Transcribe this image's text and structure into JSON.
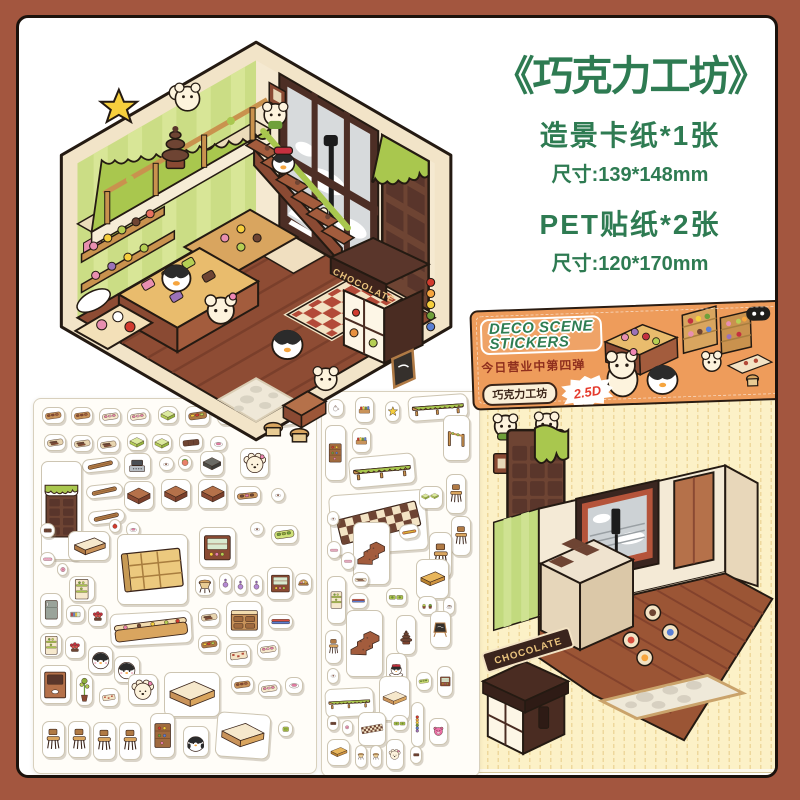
{
  "colors": {
    "frame": "#a3563f",
    "accent_green": "#2e7b52",
    "package_orange": "#ee9c5b",
    "card_yellow": "#fcf1c7",
    "choc_brown": "#6e4433",
    "slime_green": "#a9c74e",
    "badge_red": "#e5392b"
  },
  "title_block": {
    "title": "《巧克力工坊》",
    "lines": [
      {
        "text": "造景卡纸*1张"
      },
      {
        "text": "尺寸:139*148mm"
      },
      {
        "text": "PET贴纸*2张"
      },
      {
        "text": "尺寸:120*170mm"
      }
    ]
  },
  "package": {
    "logo_line1": "DECO SCENE",
    "logo_line2": "STICKERS",
    "subtitle": "今日营业中第四弹",
    "pill": "巧克力工坊",
    "badge": "2.5D"
  },
  "scene": {
    "kiosk_sign": "CHOCOLATE",
    "new_tag": "NEW"
  },
  "card": {
    "kiosk_sign": "CHOCOLATE"
  },
  "sheets": {
    "sheet1": {
      "stickers": [
        {
          "t": "tray",
          "x": 3,
          "y": 2.2,
          "w": 8,
          "h": 4.6
        },
        {
          "t": "tray",
          "x": 13,
          "y": 2.2,
          "w": 8,
          "h": 4.6
        },
        {
          "t": "traypink",
          "x": 23,
          "y": 2.4,
          "w": 8,
          "h": 4.6
        },
        {
          "t": "traypink",
          "x": 33,
          "y": 2.4,
          "w": 8,
          "h": 4.6
        },
        {
          "t": "greencube",
          "x": 44,
          "y": 1.8,
          "w": 7,
          "h": 5
        },
        {
          "t": "trayfull",
          "x": 53.5,
          "y": 2,
          "w": 9,
          "h": 5.2
        },
        {
          "t": "eclair",
          "x": 65,
          "y": 2.4,
          "w": 7,
          "h": 4.6
        },
        {
          "t": "benchcurve",
          "x": 74,
          "y": 1.6,
          "w": 23,
          "h": 6,
          "r": -7
        },
        {
          "t": "choctray",
          "x": 3.5,
          "y": 9.3,
          "w": 8,
          "h": 4.6
        },
        {
          "t": "choctray",
          "x": 13,
          "y": 9.5,
          "w": 8,
          "h": 4.6
        },
        {
          "t": "choctray",
          "x": 22.5,
          "y": 9.8,
          "w": 8,
          "h": 4.6
        },
        {
          "t": "greencube",
          "x": 33,
          "y": 9,
          "w": 7,
          "h": 5
        },
        {
          "t": "greencube",
          "x": 42,
          "y": 9.3,
          "w": 7,
          "h": 5
        },
        {
          "t": "chocflat",
          "x": 51.5,
          "y": 9,
          "w": 8.5,
          "h": 5
        },
        {
          "t": "dish",
          "x": 62.5,
          "y": 9.8,
          "w": 6,
          "h": 4.2
        },
        {
          "t": "plank",
          "x": 17,
          "y": 15.8,
          "w": 13,
          "h": 3.8,
          "r": -6
        },
        {
          "t": "register",
          "x": 32,
          "y": 14.4,
          "w": 9.5,
          "h": 6.8
        },
        {
          "t": "dishsm",
          "x": 44.5,
          "y": 15.4,
          "w": 5,
          "h": 3.8
        },
        {
          "t": "melon",
          "x": 51,
          "y": 15,
          "w": 5,
          "h": 4
        },
        {
          "t": "darkpot",
          "x": 59,
          "y": 13.8,
          "w": 8.5,
          "h": 6.8
        },
        {
          "t": "puppy",
          "x": 73,
          "y": 13.2,
          "w": 10.5,
          "h": 8
        },
        {
          "t": "chocbar",
          "x": 2.5,
          "y": 16.5,
          "w": 14.5,
          "h": 26.5
        },
        {
          "t": "plank",
          "x": 18.5,
          "y": 22.8,
          "w": 13,
          "h": 3.8,
          "r": -6
        },
        {
          "t": "cube",
          "x": 32,
          "y": 21.8,
          "w": 10.5,
          "h": 8
        },
        {
          "t": "cube",
          "x": 45,
          "y": 21.4,
          "w": 10.5,
          "h": 8
        },
        {
          "t": "cube",
          "x": 58,
          "y": 21.4,
          "w": 10.5,
          "h": 8
        },
        {
          "t": "traywide",
          "x": 71,
          "y": 23.2,
          "w": 9.5,
          "h": 5
        },
        {
          "t": "dishsm",
          "x": 84,
          "y": 23.8,
          "w": 5,
          "h": 3.8
        },
        {
          "t": "plank",
          "x": 19,
          "y": 29.8,
          "w": 13,
          "h": 3.8,
          "r": -6
        },
        {
          "t": "apple",
          "x": 26.5,
          "y": 32.2,
          "w": 4.2,
          "h": 3.6
        },
        {
          "t": "dish",
          "x": 32.5,
          "y": 32.8,
          "w": 5.2,
          "h": 4
        },
        {
          "t": "bench",
          "x": 12,
          "y": 35.2,
          "w": 15,
          "h": 8
        },
        {
          "t": "choco",
          "x": 2,
          "y": 33.2,
          "w": 5.5,
          "h": 4
        },
        {
          "t": "shelfbig",
          "x": 29.5,
          "y": 36,
          "w": 25,
          "h": 19
        },
        {
          "t": "cabinet",
          "x": 58.5,
          "y": 34.2,
          "w": 13,
          "h": 11
        },
        {
          "t": "dishsm",
          "x": 76.5,
          "y": 32.8,
          "w": 5,
          "h": 3.8
        },
        {
          "t": "greentray",
          "x": 84,
          "y": 33.8,
          "w": 9.5,
          "h": 5
        },
        {
          "t": "candy",
          "x": 2,
          "y": 40.8,
          "w": 5.5,
          "h": 3.8
        },
        {
          "t": "pinkdot",
          "x": 8,
          "y": 43.8,
          "w": 4.2,
          "h": 3.5
        },
        {
          "t": "greenrack",
          "x": 12.5,
          "y": 47.2,
          "w": 9,
          "h": 7
        },
        {
          "t": "stool",
          "x": 57,
          "y": 47,
          "w": 7,
          "h": 5.8
        },
        {
          "t": "bottle",
          "x": 65.5,
          "y": 46.6,
          "w": 4.6,
          "h": 5.4
        },
        {
          "t": "bottle",
          "x": 71,
          "y": 47,
          "w": 4.6,
          "h": 5.4
        },
        {
          "t": "bottle",
          "x": 76.5,
          "y": 47,
          "w": 4.6,
          "h": 5.4
        },
        {
          "t": "cabinet",
          "x": 82.5,
          "y": 45,
          "w": 9.5,
          "h": 8.8
        },
        {
          "t": "basket",
          "x": 92.5,
          "y": 46.4,
          "w": 6,
          "h": 5.6
        },
        {
          "t": "fridge",
          "x": 2,
          "y": 52,
          "w": 8,
          "h": 9
        },
        {
          "t": "books",
          "x": 11.5,
          "y": 55,
          "w": 6.5,
          "h": 5
        },
        {
          "t": "roses",
          "x": 19,
          "y": 55,
          "w": 7,
          "h": 6
        },
        {
          "t": "counter",
          "x": 27,
          "y": 57,
          "w": 29,
          "h": 8.8,
          "r": -3
        },
        {
          "t": "choctray",
          "x": 58,
          "y": 56,
          "w": 8,
          "h": 5
        },
        {
          "t": "desk",
          "x": 68,
          "y": 54,
          "w": 13,
          "h": 10
        },
        {
          "t": "bluebar",
          "x": 83,
          "y": 57.4,
          "w": 9,
          "h": 4
        },
        {
          "t": "greenrack",
          "x": 2,
          "y": 62.5,
          "w": 8,
          "h": 6.5
        },
        {
          "t": "roses",
          "x": 11,
          "y": 63.5,
          "w": 7,
          "h": 6
        },
        {
          "t": "penguinface",
          "x": 19,
          "y": 66,
          "w": 9,
          "h": 7.4
        },
        {
          "t": "penguinface",
          "x": 28.5,
          "y": 68.6,
          "w": 9,
          "h": 7.4
        },
        {
          "t": "trayfull",
          "x": 58,
          "y": 63,
          "w": 8,
          "h": 5
        },
        {
          "t": "rug",
          "x": 68,
          "y": 65.4,
          "w": 9,
          "h": 6
        },
        {
          "t": "traypink",
          "x": 79,
          "y": 64.4,
          "w": 8,
          "h": 5
        },
        {
          "t": "shelfopen",
          "x": 2,
          "y": 71,
          "w": 11,
          "h": 10.5
        },
        {
          "t": "planttall",
          "x": 15,
          "y": 73.5,
          "w": 6,
          "h": 8.5
        },
        {
          "t": "rug",
          "x": 23,
          "y": 77.4,
          "w": 7,
          "h": 5
        },
        {
          "t": "puppy",
          "x": 33.5,
          "y": 73.4,
          "w": 10.5,
          "h": 8.4
        },
        {
          "t": "lbench",
          "x": 46,
          "y": 73,
          "w": 20,
          "h": 12
        },
        {
          "t": "tray",
          "x": 70,
          "y": 74,
          "w": 8,
          "h": 4.6
        },
        {
          "t": "traypink",
          "x": 79.5,
          "y": 75,
          "w": 8,
          "h": 4.6
        },
        {
          "t": "dish",
          "x": 89,
          "y": 74.4,
          "w": 6.5,
          "h": 4.4
        },
        {
          "t": "chair",
          "x": 3,
          "y": 86,
          "w": 8,
          "h": 10
        },
        {
          "t": "chair",
          "x": 12,
          "y": 86,
          "w": 8,
          "h": 10
        },
        {
          "t": "chair",
          "x": 21,
          "y": 86.4,
          "w": 8,
          "h": 10
        },
        {
          "t": "chair",
          "x": 30,
          "y": 86.4,
          "w": 8,
          "h": 10
        },
        {
          "t": "shelfcol",
          "x": 41,
          "y": 84,
          "w": 9,
          "h": 12
        },
        {
          "t": "penguinbody",
          "x": 53,
          "y": 87.4,
          "w": 9,
          "h": 8.4
        },
        {
          "t": "lbench",
          "x": 64.5,
          "y": 84,
          "w": 19,
          "h": 12,
          "r": 4
        },
        {
          "t": "foodsq",
          "x": 86.5,
          "y": 86,
          "w": 5.5,
          "h": 4.4
        }
      ]
    },
    "sheet2": {
      "stickers": [
        {
          "t": "teapot",
          "x": 4,
          "y": 1.8,
          "w": 10,
          "h": 4.8
        },
        {
          "t": "crate",
          "x": 21,
          "y": 1.4,
          "w": 12,
          "h": 6.6
        },
        {
          "t": "star",
          "x": 40,
          "y": 2.4,
          "w": 10,
          "h": 5.4
        },
        {
          "t": "railing",
          "x": 55,
          "y": 0.8,
          "w": 38,
          "h": 6.6,
          "r": -4
        },
        {
          "t": "crate",
          "x": 19,
          "y": 9.4,
          "w": 12,
          "h": 6.6
        },
        {
          "t": "shelfcol",
          "x": 2,
          "y": 8.6,
          "w": 13,
          "h": 14.5
        },
        {
          "t": "railing",
          "x": 17,
          "y": 16.4,
          "w": 42,
          "h": 8,
          "r": -5
        },
        {
          "t": "vrail",
          "x": 77,
          "y": 6,
          "w": 17,
          "h": 12
        },
        {
          "t": "checker",
          "x": 5,
          "y": 26,
          "w": 62,
          "h": 16,
          "r": -4
        },
        {
          "t": "greencubes",
          "x": 62,
          "y": 24.4,
          "w": 15,
          "h": 6
        },
        {
          "t": "chair",
          "x": 79,
          "y": 21.4,
          "w": 13,
          "h": 10.4
        },
        {
          "t": "chair",
          "x": 82,
          "y": 32.4,
          "w": 13,
          "h": 10.4
        },
        {
          "t": "dishsm",
          "x": 3,
          "y": 31,
          "w": 8,
          "h": 4
        },
        {
          "t": "stairs",
          "x": 20,
          "y": 33.8,
          "w": 23,
          "h": 16.5
        },
        {
          "t": "orangebar",
          "x": 49,
          "y": 34.4,
          "w": 13,
          "h": 4,
          "r": -10
        },
        {
          "t": "candy",
          "x": 3,
          "y": 38.8,
          "w": 9,
          "h": 4.8
        },
        {
          "t": "candy",
          "x": 12,
          "y": 41.6,
          "w": 9,
          "h": 4.8
        },
        {
          "t": "chair",
          "x": 68,
          "y": 36.4,
          "w": 15,
          "h": 12
        },
        {
          "t": "chocsticks",
          "x": 19,
          "y": 46.8,
          "w": 11,
          "h": 4
        },
        {
          "t": "table",
          "x": 60,
          "y": 43.4,
          "w": 21,
          "h": 10.6
        },
        {
          "t": "greenrack",
          "x": 3,
          "y": 48,
          "w": 12,
          "h": 12.5
        },
        {
          "t": "bluebar",
          "x": 17,
          "y": 52.4,
          "w": 12,
          "h": 4
        },
        {
          "t": "greenpads",
          "x": 41,
          "y": 51,
          "w": 13,
          "h": 4.8
        },
        {
          "t": "pots",
          "x": 61,
          "y": 53,
          "w": 12,
          "h": 5.2
        },
        {
          "t": "teacup",
          "x": 77,
          "y": 53.4,
          "w": 8,
          "h": 4.8
        },
        {
          "t": "stairs",
          "x": 15,
          "y": 56.8,
          "w": 24,
          "h": 17.5
        },
        {
          "t": "blackboard",
          "x": 69,
          "y": 57,
          "w": 13,
          "h": 9.6
        },
        {
          "t": "chair",
          "x": 2,
          "y": 62,
          "w": 11,
          "h": 8.8
        },
        {
          "t": "fountain",
          "x": 47,
          "y": 58,
          "w": 13,
          "h": 10.6
        },
        {
          "t": "penguincake",
          "x": 41,
          "y": 68,
          "w": 13,
          "h": 8.8
        },
        {
          "t": "dishsm",
          "x": 3,
          "y": 72,
          "w": 8,
          "h": 4
        },
        {
          "t": "railing",
          "x": 2,
          "y": 77,
          "w": 31,
          "h": 7.6,
          "r": -3
        },
        {
          "t": "lbench",
          "x": 36,
          "y": 74,
          "w": 20,
          "h": 11.6
        },
        {
          "t": "greentray",
          "x": 60,
          "y": 73,
          "w": 10,
          "h": 4.8
        },
        {
          "t": "cabinet",
          "x": 73,
          "y": 71.4,
          "w": 10.5,
          "h": 8
        },
        {
          "t": "choco",
          "x": 3,
          "y": 84,
          "w": 8,
          "h": 4.4
        },
        {
          "t": "pinkdot",
          "x": 13,
          "y": 85.4,
          "w": 6.5,
          "h": 3.8
        },
        {
          "t": "checker",
          "x": 23,
          "y": 83.4,
          "w": 18,
          "h": 8.8
        },
        {
          "t": "greenpads",
          "x": 44,
          "y": 84,
          "w": 11,
          "h": 4.4
        },
        {
          "t": "candystrip",
          "x": 57,
          "y": 80.8,
          "w": 8,
          "h": 11.6
        },
        {
          "t": "pinkbear",
          "x": 68,
          "y": 85,
          "w": 12,
          "h": 6.8
        },
        {
          "t": "table",
          "x": 3,
          "y": 90.4,
          "w": 15,
          "h": 7
        },
        {
          "t": "stool",
          "x": 21,
          "y": 92,
          "w": 7.5,
          "h": 5.8
        },
        {
          "t": "stool",
          "x": 30.5,
          "y": 92,
          "w": 7.5,
          "h": 5.8
        },
        {
          "t": "puppy",
          "x": 41,
          "y": 90.4,
          "w": 11,
          "h": 8
        },
        {
          "t": "choco",
          "x": 56,
          "y": 92.2,
          "w": 8,
          "h": 4.6
        }
      ]
    }
  }
}
